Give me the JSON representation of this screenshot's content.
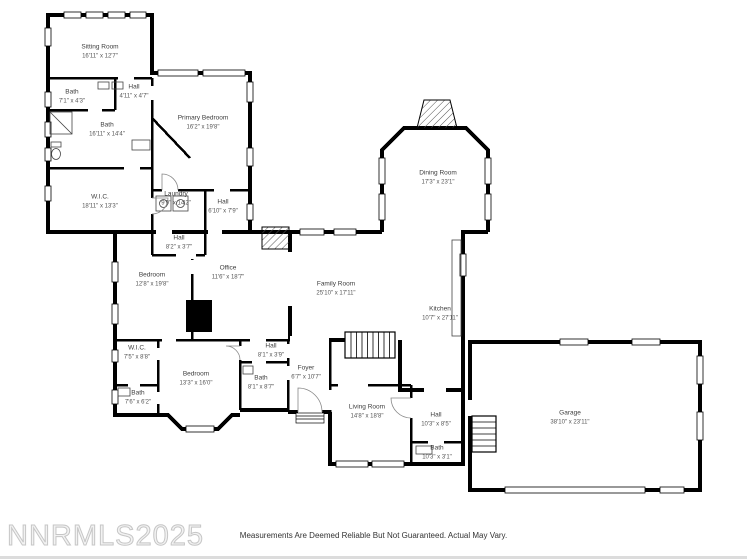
{
  "plan": {
    "watermark": "NNRMLS2025",
    "disclaimer": "Measurements Are Deemed Reliable But Not Guaranteed. Actual May Vary.",
    "rooms": [
      {
        "id": "sitting-room",
        "name": "Sitting Room",
        "dims": "16'11\" x 12'7\""
      },
      {
        "id": "bath-1",
        "name": "Bath",
        "dims": "7'1\" x 4'3\""
      },
      {
        "id": "hall-1",
        "name": "Hall",
        "dims": "4'11\" x 4'7\""
      },
      {
        "id": "bath-2",
        "name": "Bath",
        "dims": "16'11\" x 14'4\""
      },
      {
        "id": "primary-bedroom",
        "name": "Primary Bedroom",
        "dims": "16'2\" x 19'8\""
      },
      {
        "id": "laundry",
        "name": "Laundry",
        "dims": "9'9\" x 14'2\""
      },
      {
        "id": "hall-2",
        "name": "Hall",
        "dims": "6'10\" x 7'9\""
      },
      {
        "id": "wic-1",
        "name": "W.I.C.",
        "dims": "18'11\" x 13'3\""
      },
      {
        "id": "hall-3",
        "name": "Hall",
        "dims": "8'2\" x 3'7\""
      },
      {
        "id": "bedroom-1",
        "name": "Bedroom",
        "dims": "12'8\" x 19'8\""
      },
      {
        "id": "office",
        "name": "Office",
        "dims": "11'6\" x 18'7\""
      },
      {
        "id": "family-room",
        "name": "Family Room",
        "dims": "25'10\" x 17'11\""
      },
      {
        "id": "dining-room",
        "name": "Dining Room",
        "dims": "17'3\" x 23'1\""
      },
      {
        "id": "kitchen",
        "name": "Kitchen",
        "dims": "10'7\" x 27'11\""
      },
      {
        "id": "wic-2",
        "name": "W.I.C.",
        "dims": "7'5\" x 8'8\""
      },
      {
        "id": "bedroom-2",
        "name": "Bedroom",
        "dims": "13'3\" x 16'0\""
      },
      {
        "id": "bath-3",
        "name": "Bath",
        "dims": "7'6\" x 6'2\""
      },
      {
        "id": "hall-4",
        "name": "Hall",
        "dims": "8'1\" x 3'9\""
      },
      {
        "id": "bath-4",
        "name": "Bath",
        "dims": "8'1\" x 8'7\""
      },
      {
        "id": "foyer",
        "name": "Foyer",
        "dims": "6'7\" x 10'7\""
      },
      {
        "id": "living-room",
        "name": "Living Room",
        "dims": "14'8\" x 18'8\""
      },
      {
        "id": "hall-5",
        "name": "Hall",
        "dims": "10'3\" x 8'5\""
      },
      {
        "id": "bath-5",
        "name": "Bath",
        "dims": "10'3\" x 3'1\""
      },
      {
        "id": "garage",
        "name": "Garage",
        "dims": "38'10\" x 23'11\""
      }
    ],
    "colors": {
      "wall": "#000000",
      "label_text": "#3d3d3d",
      "watermark_outline": "#c6c6c6",
      "disclaimer_text": "#333333"
    }
  }
}
